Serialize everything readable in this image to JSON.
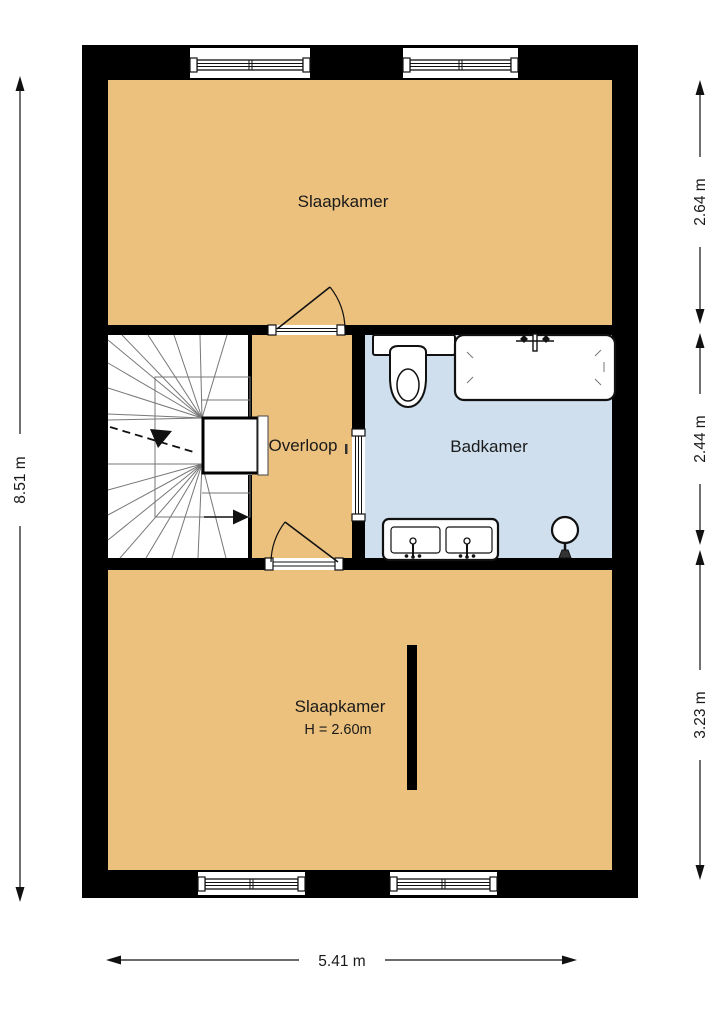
{
  "title": "Floor plan - first floor",
  "colors": {
    "wall": "#000000",
    "room_floor": "#ecc17e",
    "bathroom_floor": "#cfdfee",
    "stairs_floor": "#ffffff",
    "line": "#1a1a1a"
  },
  "rooms": {
    "bedroom_top": {
      "label": "Slaapkamer"
    },
    "landing": {
      "label": "Overloop"
    },
    "bathroom": {
      "label": "Badkamer"
    },
    "bedroom_bottom": {
      "label": "Slaapkamer",
      "height_note": "H = 2.60m"
    }
  },
  "dimensions": {
    "total_height": "8.51 m",
    "total_width": "5.41 m",
    "top_section_depth": "2.64 m",
    "middle_section_depth": "2.44 m",
    "bottom_section_depth": "3.23 m"
  },
  "fixtures": {
    "stairs": "winder-staircase",
    "toilet": "toilet",
    "bathtub": "bathtub",
    "vanity": "double-sink-vanity",
    "lamp": "floor-lamp"
  }
}
